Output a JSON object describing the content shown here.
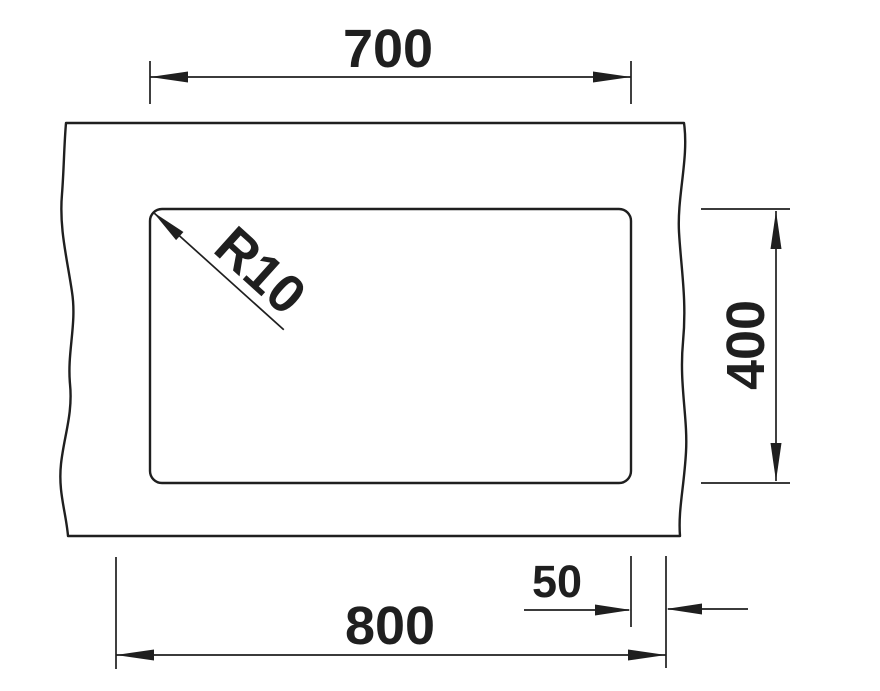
{
  "page": {
    "background_color": "#ffffff"
  },
  "drawing": {
    "title": "sink-cutout-dimension-drawing",
    "ink_color": "#1f1f1f",
    "dimensions": {
      "cutout_width": "700",
      "cutout_depth": "400",
      "edge_offset": "50",
      "cabinet_width": "800",
      "corner_radius": "R10"
    }
  }
}
